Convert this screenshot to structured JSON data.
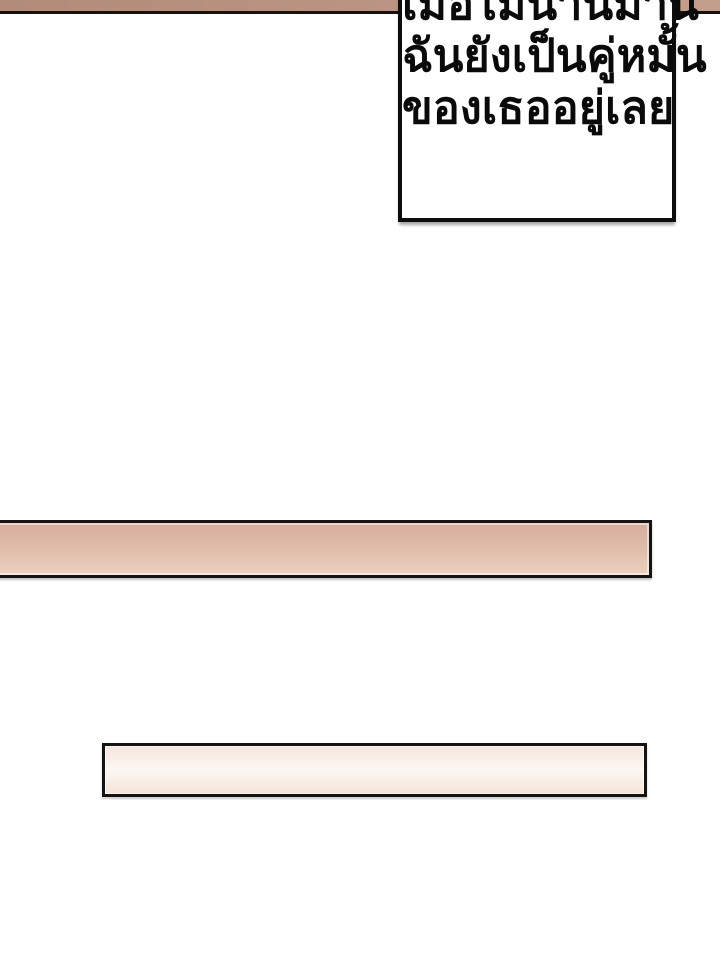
{
  "page": {
    "background_color": "#ffffff",
    "kind": "webtoon-comic-panel"
  },
  "top_strip": {
    "color_left": "#b28b79",
    "color_right": "#c49e8c",
    "border_color": "#151210"
  },
  "speech_bubble": {
    "background_color": "#ffffff",
    "border_color": "#0d0d0d",
    "lines": [
      "เมื่อไม่นานมานี้",
      "ฉันยังเป็นคู่หมั้น",
      "ของเธออยู่เลย"
    ]
  },
  "middle_bar": {
    "fill_top_color": "#d5ad9c",
    "fill_bottom_color": "#ecd2c0",
    "border_color": "#171310"
  },
  "lower_bar": {
    "fill_top_color": "#f5e6db",
    "fill_bottom_color": "#f4e3d7",
    "border_color": "#171310"
  }
}
